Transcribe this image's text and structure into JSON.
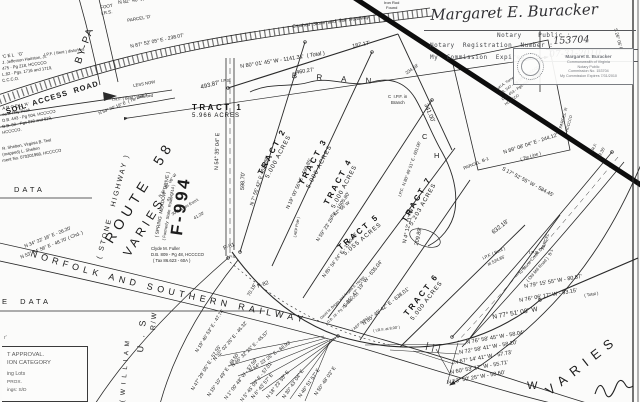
{
  "colors": {
    "ink": "#1c1c1c",
    "paper": "#fbfbfa",
    "stamp_ink": "#74777d"
  },
  "notary": {
    "signature": "Margaret E. Buracker",
    "public_label": "Notary    Public :",
    "reg_label": "Notary  Registration  Number :",
    "reg_value": "153704",
    "exp_label": "My  Commission  Expires :",
    "exp_value": "07-31-2010"
  },
  "stamp": {
    "l1": "Margaret E. Buracker",
    "l2": "Commonwealth of Virginia",
    "l3": "Notary Public",
    "l4": "Commission No. 153704",
    "l5": "My Commission Expires 7/31/2010"
  },
  "roads": {
    "railway": "NORFOLK   AND   SOUTHERN   RAILWAY",
    "route58": "ROUTE  58",
    "varies": "VARIES",
    "stone_highway": "( STONE   HIGHWAY )",
    "f994": "F-994",
    "spring_meadow": "( SPRING  MEADOW  DRIVE )",
    "spring_meadow_former": "( Formerly  State  Route  714 )",
    "bypass": "BY-PA",
    "soil_access": "SOIL  ACCESS  ROAD",
    "crushed": "Crushed  Stone  and  Soil  Roadway",
    "william": "( W I L L I A M",
    "us": "U . S",
    "rw": "R / W",
    "varies_big": "VARIES",
    "w": "W"
  },
  "tables": {
    "data1": "DATA",
    "data2": "E  DATA"
  },
  "approval": {
    "mark": "r'",
    "line1": "T APPROVAL.",
    "line2": "ION CATEGORY",
    "line3": "ing Lots",
    "line4": "PROX.",
    "line5": "ings: S/D"
  },
  "tracts": [
    {
      "name": "TRACT  1",
      "acres": "5.966  ACRES"
    },
    {
      "name": "TRACT  2",
      "acres": "5.000  ACRES"
    },
    {
      "name": "TRACT  3",
      "acres": "5.000  ACRES"
    },
    {
      "name": "TRACT  4",
      "acres": "5.000  ACRES"
    },
    {
      "name": "TRACT  5",
      "acres": "5.055  ACRES"
    },
    {
      "name": "TRACT  6",
      "acres": "5.000  ACRES"
    },
    {
      "name": "TRACT  7",
      "acres": "5.203  ACRES"
    }
  ],
  "annotations": [
    {
      "t": "FOOT",
      "x": 100,
      "y": 6,
      "r": -10,
      "fs": 4.5
    },
    {
      "t": "I.R.S.",
      "x": 101,
      "y": 12,
      "r": -10,
      "fs": 4.5
    },
    {
      "t": "N 82° 40' W - 274.05'",
      "x": 118,
      "y": 1,
      "r": -8,
      "fs": 5
    },
    {
      "t": "PARCEL 'D'",
      "x": 127,
      "y": 19,
      "r": -10,
      "fs": 4.5
    },
    {
      "t": "N 87° 52' 05\" E - 238.07'",
      "x": 130,
      "y": 45,
      "r": -12,
      "fs": 5
    },
    {
      "t": "'C E L   'G'",
      "x": 2,
      "y": 55,
      "r": -8,
      "fs": 4.5
    },
    {
      "t": "J. Jefferson Hairston, Jr.",
      "x": 2,
      "y": 61,
      "r": -8,
      "fs": 4.2
    },
    {
      "t": "475 - Pg 218, HCCCCO",
      "x": 2,
      "y": 67,
      "r": -8,
      "fs": 4.2
    },
    {
      "t": "L.82 - Pgs. 1716 and 1719,",
      "x": 2,
      "y": 73,
      "r": -8,
      "fs": 4.2
    },
    {
      "t": "C.C.C.O.",
      "x": 2,
      "y": 79,
      "r": -8,
      "fs": 4.2
    },
    {
      "t": "I.P.F. ( Bent ) disturbed",
      "x": 44,
      "y": 53,
      "r": -8,
      "fs": 4
    },
    {
      "t": "A R C E L  'A'",
      "x": 2,
      "y": 107,
      "r": -10,
      "fs": 4.5
    },
    {
      "t": "es J. Ray Peak",
      "x": 2,
      "y": 113,
      "r": -10,
      "fs": 4.2
    },
    {
      "t": "D.B. 443 - Pg 504, HCCCCO",
      "x": 2,
      "y": 119,
      "r": -10,
      "fs": 4.2
    },
    {
      "t": "D.B. 82 - Pgs 818 and 819,",
      "x": 2,
      "y": 125,
      "r": -10,
      "fs": 4.2
    },
    {
      "t": "HCCCCO.",
      "x": 2,
      "y": 131,
      "r": -10,
      "fs": 4.2
    },
    {
      "t": "R. Shelton, Virginia B. Teel",
      "x": 2,
      "y": 147,
      "r": -10,
      "fs": 4.2
    },
    {
      "t": "(mapped) L. Shelton",
      "x": 2,
      "y": 153,
      "r": -10,
      "fs": 4.2
    },
    {
      "t": "ment No. 070301968, HCCCCO",
      "x": 2,
      "y": 159,
      "r": -10,
      "fs": 4.2
    },
    {
      "t": "N 54° 20' 19\" E  ( Tie Line )",
      "x": 98,
      "y": 112,
      "r": -22,
      "fs": 4.3
    },
    {
      "t": "I.R.F. ( Bent ) disturbed",
      "x": 112,
      "y": 98,
      "r": -6,
      "fs": 4
    },
    {
      "t": "LESS NOW",
      "x": 133,
      "y": 84,
      "r": -10,
      "fs": 4.2
    },
    {
      "t": "493.87'",
      "x": 200,
      "y": 85,
      "r": -14,
      "fs": 6
    },
    {
      "t": "I.P.S.",
      "x": 221,
      "y": 79,
      "r": 0,
      "fs": 4.3
    },
    {
      "t": "N 80° 01' 45\" W - 1141.31'  ( Total )",
      "x": 240,
      "y": 65,
      "r": -9,
      "fs": 5.5
    },
    {
      "t": "460.27'",
      "x": 296,
      "y": 71,
      "r": -9,
      "fs": 5.5
    },
    {
      "t": "187.17'",
      "x": 352,
      "y": 45,
      "r": -12,
      "fs": 5.5
    },
    {
      "t": "Iron Rod",
      "x": 384,
      "y": 1,
      "r": 0,
      "fs": 4
    },
    {
      "t": "Found",
      "x": 386,
      "y": 6,
      "r": 0,
      "fs": 4
    },
    {
      "t": "C  I.P.F. in",
      "x": 388,
      "y": 95,
      "r": 0,
      "fs": 4.3
    },
    {
      "t": "Branch",
      "x": 391,
      "y": 101,
      "r": 0,
      "fs": 4.3
    },
    {
      "t": "B  R  A  N",
      "x": 292,
      "y": 72,
      "r": 4,
      "fs": 8,
      "ls": 5
    },
    {
      "t": "C",
      "x": 422,
      "y": 133,
      "r": 0,
      "fs": 7.5
    },
    {
      "t": "H",
      "x": 434,
      "y": 152,
      "r": 0,
      "fs": 7.5
    },
    {
      "t": "N 7° 55' 42\" E - 621.86'",
      "x": 250,
      "y": 205,
      "r": -72,
      "fs": 5
    },
    {
      "t": "N 19° 00' 56\" E - 599.85'",
      "x": 286,
      "y": 208,
      "r": -65,
      "fs": 5
    },
    {
      "t": "N 59° 23' 26\" E - 1605.80'",
      "x": 316,
      "y": 240,
      "r": -57,
      "fs": 5
    },
    {
      "t": "I.P.F.  N 80° 40' 51\" E - 601.06'",
      "x": 398,
      "y": 196,
      "r": -70,
      "fs": 4.3
    },
    {
      "t": "N 85° 54' 24\" E - 1190.13'",
      "x": 322,
      "y": 276,
      "r": -53,
      "fs": 4.8
    },
    {
      "t": "S 85° 47' 19\" W - 635.04'",
      "x": 343,
      "y": 306,
      "r": -51,
      "fs": 5.3
    },
    {
      "t": "N 85° 45' 42\" E - 638.01'",
      "x": 362,
      "y": 323,
      "r": -38,
      "fs": 5.3
    },
    {
      "t": "David M. Briggs and Angela S. Hodge",
      "x": 320,
      "y": 318,
      "r": -44,
      "fs": 3.6
    },
    {
      "t": "D.B. 18 - Pg 70, HCCCCO",
      "x": 327,
      "y": 322,
      "r": -44,
      "fs": 3.6
    },
    {
      "t": "N 4° 12' 11\" W",
      "x": 403,
      "y": 243,
      "r": -78,
      "fs": 5.5
    },
    {
      "t": "209.89'",
      "x": 415,
      "y": 245,
      "r": -78,
      "fs": 5.5
    },
    {
      "t": "S 61° 56' W",
      "x": 330,
      "y": 216,
      "r": -40,
      "fs": 4.5
    },
    {
      "t": "341.00'",
      "x": 428,
      "y": 103,
      "r": 68,
      "fs": 6
    },
    {
      "t": "234.59'",
      "x": 405,
      "y": 72,
      "r": -35,
      "fs": 4.5
    },
    {
      "t": "Lori A. Turner",
      "x": 495,
      "y": 88,
      "r": -35,
      "fs": 3.8
    },
    {
      "t": "D.B. 547 - Pg 583, HCCCCO",
      "x": 498,
      "y": 93,
      "r": -35,
      "fs": 3.8
    },
    {
      "t": "D.B. 453 - Pgs 493 and 496,",
      "x": 501,
      "y": 98,
      "r": -35,
      "fs": 3.8
    },
    {
      "t": "HCCCCO",
      "x": 504,
      "y": 103,
      "r": -35,
      "fs": 3.8
    },
    {
      "t": "PARCEL 'A'",
      "x": 559,
      "y": 128,
      "r": -75,
      "fs": 4.2
    },
    {
      "t": "HCCCCO",
      "x": 565,
      "y": 131,
      "r": -75,
      "fs": 3.8
    },
    {
      "t": "N 89° 08' 04\" E - 244.12'",
      "x": 503,
      "y": 151,
      "r": -18,
      "fs": 5.2
    },
    {
      "t": "( Tie Line )",
      "x": 520,
      "y": 158,
      "r": -18,
      "fs": 4.5
    },
    {
      "t": "S 17° 52' 55\" W - 584.45'",
      "x": 503,
      "y": 167,
      "r": 28,
      "fs": 5.2
    },
    {
      "t": "PARCEL  B-1",
      "x": 463,
      "y": 167,
      "r": -22,
      "fs": 4.5
    },
    {
      "t": "PARCEL",
      "x": 541,
      "y": 249,
      "r": -72,
      "fs": 4.3
    },
    {
      "t": "B-1",
      "x": 548,
      "y": 255,
      "r": -72,
      "fs": 4.3
    },
    {
      "t": "632.18'",
      "x": 491,
      "y": 231,
      "r": -38,
      "fs": 6
    },
    {
      "t": "I.P.F. ( Bent )",
      "x": 482,
      "y": 257,
      "r": -25,
      "fs": 4.3
    },
    {
      "t": "at 524.85'",
      "x": 487,
      "y": 263,
      "r": -25,
      "fs": 4.3
    },
    {
      "t": "I.P.S.",
      "x": 529,
      "y": 251,
      "r": 0,
      "fs": 4.3
    },
    {
      "t": "To Stone Creek Dev.",
      "x": 518,
      "y": 273,
      "r": -49,
      "fs": 4.3
    },
    {
      "t": "( Old Mill Road )",
      "x": 526,
      "y": 280,
      "r": -49,
      "fs": 4.3
    },
    {
      "t": "N 79° 15' 55\" W - 80.57'",
      "x": 524,
      "y": 285,
      "r": -10,
      "fs": 5.5
    },
    {
      "t": "( Total )",
      "x": 584,
      "y": 294,
      "r": -10,
      "fs": 4.3
    },
    {
      "t": "N 76° 06' 17\" W - 93.15'",
      "x": 519,
      "y": 299,
      "r": -10,
      "fs": 5.5
    },
    {
      "t": "N 77° 51' 08\" W",
      "x": 492,
      "y": 315,
      "r": -10,
      "fs": 6.5
    },
    {
      "t": "N 76° 58' 45\" W - 58.04'",
      "x": 466,
      "y": 341,
      "r": -10,
      "fs": 5.5
    },
    {
      "t": "N 72° 58' 41\" W - 58.20'",
      "x": 459,
      "y": 351,
      "r": -10,
      "fs": 5.5
    },
    {
      "t": "N 67° 14' 41\" W - 57.73'",
      "x": 454,
      "y": 361,
      "r": -10,
      "fs": 5.5
    },
    {
      "t": "N 60° 53' 17\" W - 55.71'",
      "x": 450,
      "y": 371,
      "r": -10,
      "fs": 5.5
    },
    {
      "t": "N 53° 50' 25\" W - 58.60'",
      "x": 447,
      "y": 381,
      "r": -10,
      "fs": 5.5
    },
    {
      "t": "N 50° 48' 03\" E",
      "x": 314,
      "y": 394,
      "r": -55,
      "fs": 5
    },
    {
      "t": "N 46° 51' 57\" E",
      "x": 298,
      "y": 396,
      "r": -55,
      "fs": 5
    },
    {
      "t": "N 30° 43' 04\" E",
      "x": 282,
      "y": 397,
      "r": -55,
      "fs": 5
    },
    {
      "t": "N 18° 23' 55\" E",
      "x": 266,
      "y": 397,
      "r": -52,
      "fs": 5
    },
    {
      "t": "N 6° 43' 57\" E",
      "x": 251,
      "y": 397,
      "r": -50,
      "fs": 5
    },
    {
      "t": "N 5° 45' 05\" E - 57.01'",
      "x": 240,
      "y": 400,
      "r": -52,
      "fs": 5
    },
    {
      "t": "N 1° 00' 48\" W - 57.59'",
      "x": 224,
      "y": 398,
      "r": -52,
      "fs": 5
    },
    {
      "t": "N 15° 10' 49\" E - 48.50'",
      "x": 207,
      "y": 395,
      "r": -55,
      "fs": 5
    },
    {
      "t": "N 47° 29' 05\" E - 57.55'",
      "x": 191,
      "y": 389,
      "r": -58,
      "fs": 5
    },
    {
      "t": "N 19° 40' 53\" E - 47.74'",
      "x": 195,
      "y": 351,
      "r": -58,
      "fs": 4.8
    },
    {
      "t": "N 32° 02' 26\" E - 46.32'",
      "x": 213,
      "y": 359,
      "r": -50,
      "fs": 4.8
    },
    {
      "t": "N 46° 32' 25\" E - 45.57'",
      "x": 231,
      "y": 365,
      "r": -44,
      "fs": 4.8
    },
    {
      "t": "N 64° 23' 25\" E - 68.93'",
      "x": 249,
      "y": 370,
      "r": -36,
      "fs": 4.8
    },
    {
      "t": "( I.R.F. at 8.00' )",
      "x": 373,
      "y": 329,
      "r": -8,
      "fs": 3.8
    },
    {
      "t": "( AEP Pole )",
      "x": 293,
      "y": 237,
      "r": -80,
      "fs": 3.8
    },
    {
      "t": "( AEP Pole )",
      "x": 351,
      "y": 329,
      "r": -40,
      "fs": 3.8
    },
    {
      "t": "70.19'",
      "x": 247,
      "y": 295,
      "r": -60,
      "fs": 5
    },
    {
      "t": "P-81",
      "x": 223,
      "y": 247,
      "r": -20,
      "fs": 5.5
    },
    {
      "t": "P-82",
      "x": 257,
      "y": 285,
      "r": -20,
      "fs": 5.5
    },
    {
      "t": "N 34° 22' 16\" E - 26.20'",
      "x": 24,
      "y": 245,
      "r": -22,
      "fs": 4.8
    },
    {
      "t": "N 53° 34' 56\" E - 48.70' ( Chd. )",
      "x": 20,
      "y": 256,
      "r": -22,
      "fs": 4.8
    },
    {
      "t": "Clyde M. Fuller",
      "x": 151,
      "y": 247,
      "r": 0,
      "fs": 4.3
    },
    {
      "t": "D.B. 809 - Pg 48, HCCCCO",
      "x": 151,
      "y": 253,
      "r": 0,
      "fs": 4.3
    },
    {
      "t": "( Tax 86.623 - 60A )",
      "x": 153,
      "y": 259,
      "r": 0,
      "fs": 4.3
    },
    {
      "t": "N 54° 35' 04\" E",
      "x": 215,
      "y": 170,
      "r": -88,
      "fs": 5.5
    },
    {
      "t": "598.70'",
      "x": 241,
      "y": 190,
      "r": -88,
      "fs": 5.5
    },
    {
      "t": "N 34° 02' 06\" W",
      "x": 158,
      "y": 196,
      "r": -55,
      "fs": 4
    },
    {
      "t": "43.42'",
      "x": 166,
      "y": 200,
      "r": -55,
      "fs": 4
    },
    {
      "t": "30' Access Esm't.",
      "x": 171,
      "y": 213,
      "r": -30,
      "fs": 4
    },
    {
      "t": "41.20'",
      "x": 193,
      "y": 217,
      "r": -30,
      "fs": 4.3
    },
    {
      "t": "I.P.S.",
      "x": 227,
      "y": 255,
      "r": 0,
      "fs": 4
    },
    {
      "t": "S 26° 05' E",
      "x": 617,
      "y": 28,
      "r": 75,
      "fs": 4.5
    },
    {
      "t": "I.R.F.",
      "x": 590,
      "y": 151,
      "r": -62,
      "fs": 4
    },
    {
      "t": "209.35'",
      "x": 596,
      "y": 159,
      "r": -62,
      "fs": 4.3
    }
  ]
}
